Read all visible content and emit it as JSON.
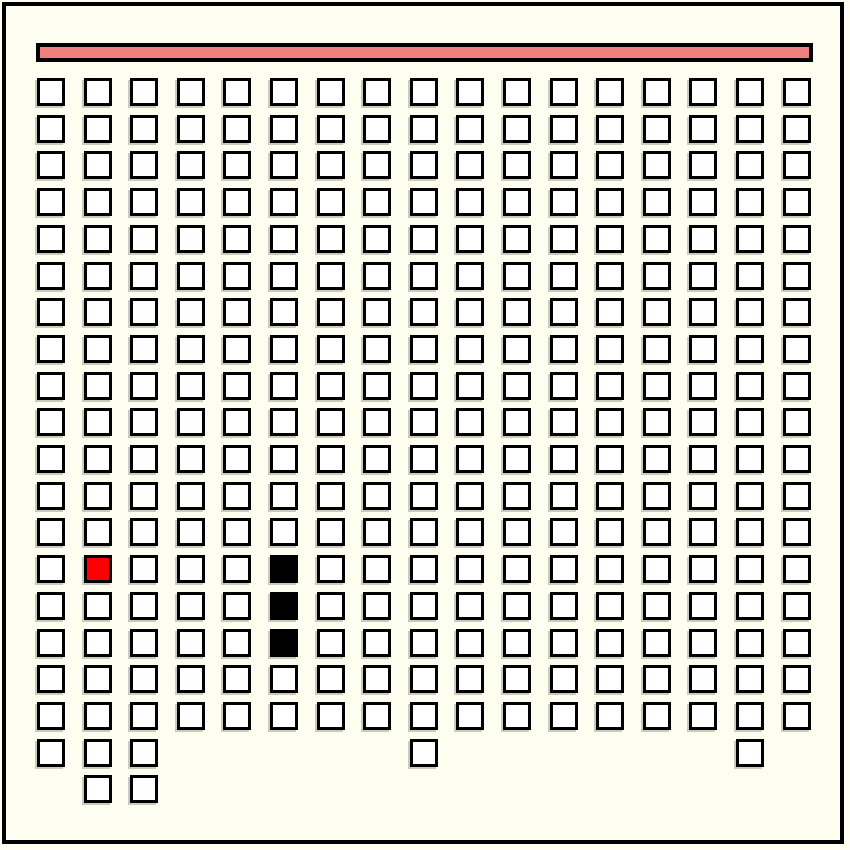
{
  "window": {
    "background_color": "#FDFDF0",
    "frame_color": "#000000"
  },
  "progress_bar": {
    "fill_color": "#F08080",
    "border_color": "#000000"
  },
  "grid": {
    "columns": 17,
    "max_rows": 20,
    "rows_per_column": [
      19,
      20,
      20,
      18,
      18,
      18,
      18,
      18,
      19,
      18,
      18,
      18,
      18,
      18,
      18,
      19,
      18
    ],
    "cell_states": {
      "empty_color": "#FFFFFF",
      "red_color": "#FF0000",
      "black_color": "#000000",
      "border_color": "#000000"
    },
    "special_cells": [
      {
        "col": 1,
        "row": 13,
        "state": "red"
      },
      {
        "col": 5,
        "row": 13,
        "state": "black"
      },
      {
        "col": 5,
        "row": 14,
        "state": "black"
      },
      {
        "col": 5,
        "row": 15,
        "state": "black"
      }
    ]
  }
}
